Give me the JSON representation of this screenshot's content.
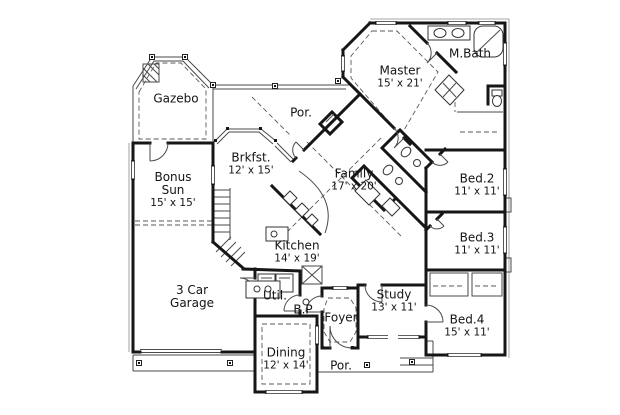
{
  "plan": {
    "type": "residential-floor-plan",
    "colors": {
      "background": "#ffffff",
      "walls": "#161616",
      "thin_lines": "#4a4a4a"
    },
    "rooms": {
      "gazebo": {
        "name": "Gazebo"
      },
      "porch_top": {
        "name": "Por."
      },
      "master": {
        "name": "Master",
        "dims": "15' x 21'"
      },
      "master_bath": {
        "name": "M.Bath"
      },
      "breakfast": {
        "name": "Brkfst.",
        "dims": "12' x 15'"
      },
      "family": {
        "name": "Family",
        "dims": "17' x 20'"
      },
      "bed2": {
        "name": "Bed.2",
        "dims": "11' x 11'"
      },
      "bonus_sun": {
        "name": "Bonus Sun",
        "dims": "15' x 15'"
      },
      "kitchen": {
        "name": "Kitchen",
        "dims": "14' x 19'"
      },
      "bed3": {
        "name": "Bed.3",
        "dims": "11' x 11'"
      },
      "garage": {
        "name": "3 Car Garage"
      },
      "utility": {
        "name": "Util."
      },
      "bp": {
        "name": "B.P"
      },
      "foyer": {
        "name": "Foyer"
      },
      "study": {
        "name": "Study",
        "dims": "13' x 11'"
      },
      "bed4": {
        "name": "Bed.4",
        "dims": "15' x 11'"
      },
      "dining": {
        "name": "Dining",
        "dims": "12' x 14'"
      },
      "porch_bottom": {
        "name": "Por."
      }
    }
  }
}
